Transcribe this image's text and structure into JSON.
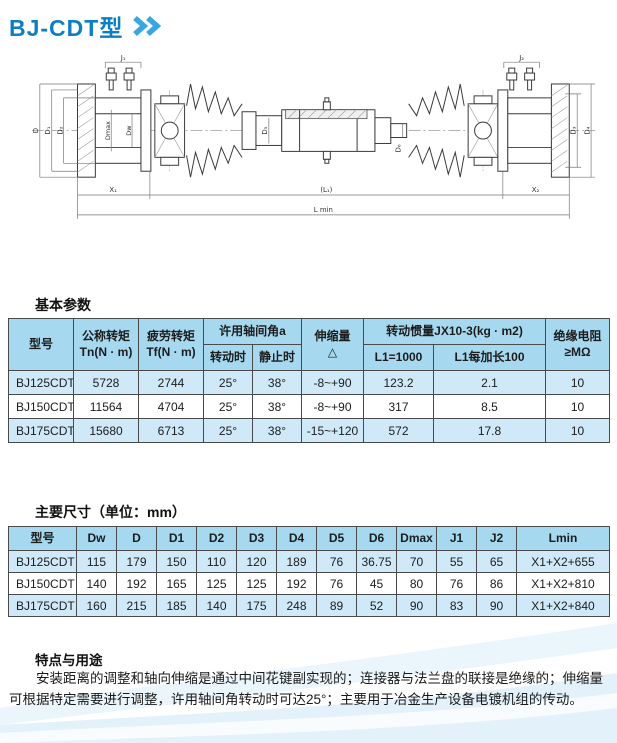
{
  "page": {
    "title": "BJ-CDT型"
  },
  "drawing": {
    "labels": {
      "j1": "J₁",
      "j2": "J₂",
      "d": "D",
      "d1": "D₁",
      "d2": "D₂",
      "dmax": "Dmax",
      "dw": "Dw",
      "d5": "D₅",
      "d6": "D₆",
      "d3": "D₃",
      "d4": "D₄",
      "x1": "X₁",
      "l1": "(L₁)",
      "x2": "X₂",
      "lmin": "L min"
    }
  },
  "basic_params": {
    "section_title": "基本参数",
    "headers": {
      "model": "型号",
      "nominal_torque_l1": "公称转矩",
      "nominal_torque_l2": "Tn(N · m)",
      "fatigue_torque_l1": "疲劳转矩",
      "fatigue_torque_l2": "Tf(N · m)",
      "angle_group": "许用轴间角a",
      "angle_rotating": "转动时",
      "angle_static": "静止时",
      "extension_l1": "伸缩量",
      "extension_l2": "△",
      "inertia_group": "转动惯量JX10-3(kg · m2)",
      "inertia_l1000": "L1=1000",
      "inertia_per100": "L1每加长100",
      "insulation_l1": "绝缘电阻",
      "insulation_l2": "≥MΩ"
    },
    "rows": [
      [
        "BJ125CDT",
        "5728",
        "2744",
        "25°",
        "38°",
        "-8~+90",
        "123.2",
        "2.1",
        "10"
      ],
      [
        "BJ150CDT",
        "11564",
        "4704",
        "25°",
        "38°",
        "-8~+90",
        "317",
        "8.5",
        "10"
      ],
      [
        "BJ175CDT",
        "15680",
        "6713",
        "25°",
        "38°",
        "-15~+120",
        "572",
        "17.8",
        "10"
      ]
    ]
  },
  "dimensions": {
    "section_title": "主要尺寸（单位：mm）",
    "headers": [
      "型号",
      "Dw",
      "D",
      "D1",
      "D2",
      "D3",
      "D4",
      "D5",
      "D6",
      "Dmax",
      "J1",
      "J2",
      "Lmin"
    ],
    "rows": [
      [
        "BJ125CDT",
        "115",
        "179",
        "150",
        "110",
        "120",
        "189",
        "76",
        "36.75",
        "70",
        "55",
        "65",
        "X1+X2+655"
      ],
      [
        "BJ150CDT",
        "140",
        "192",
        "165",
        "125",
        "125",
        "192",
        "76",
        "45",
        "80",
        "76",
        "86",
        "X1+X2+810"
      ],
      [
        "BJ175CDT",
        "160",
        "215",
        "185",
        "140",
        "175",
        "248",
        "89",
        "52",
        "90",
        "83",
        "90",
        "X1+X2+840"
      ]
    ]
  },
  "features": {
    "section_title": "特点与用途",
    "paragraph": "安装距离的调整和轴向伸缩是通过中间花键副实现的；连接器与法兰盘的联接是绝缘的；伸缩量可根据特定需要进行调整，许用轴间角转动时可达25°；主要用于冶金生产设备电镀机组的传动。"
  },
  "colors": {
    "title_blue": "#0d7ec6",
    "chevron_blue": "#38a6e0",
    "table_header_bg": "#a6d9f0",
    "table_row_alt_bg": "#cfe9f8",
    "table_border": "#4a4a4a"
  }
}
